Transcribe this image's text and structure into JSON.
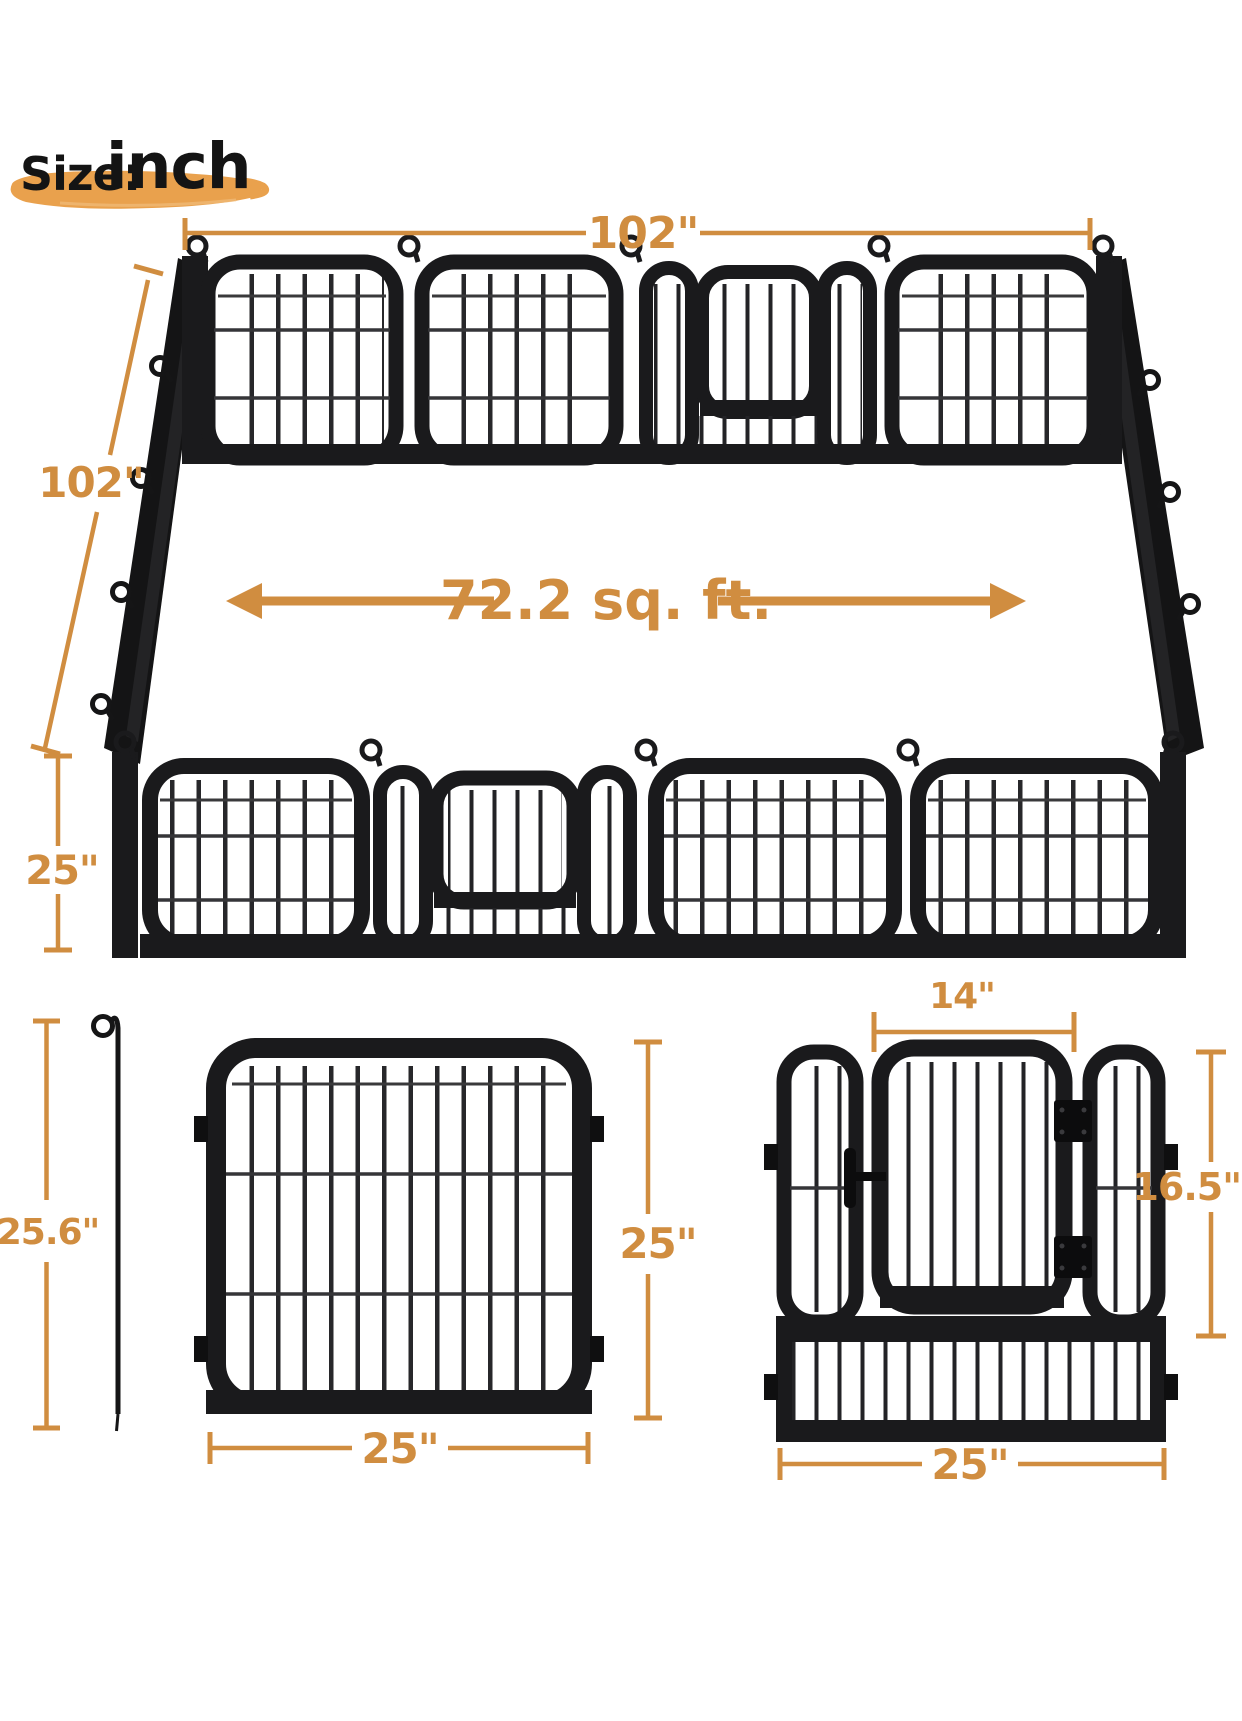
{
  "title": {
    "size_label": "Size:",
    "unit_label": "inch"
  },
  "pen": {
    "top_width": "102\"",
    "side_depth": "102\"",
    "front_height": "25\"",
    "area": "72.2 sq. ft."
  },
  "panel_fig": {
    "stake_height": "25.6\"",
    "height": "25\"",
    "width": "25\""
  },
  "gate_fig": {
    "door_width": "14\"",
    "door_height": "16.5\"",
    "width": "25\""
  },
  "colors": {
    "accent": "#D08D40",
    "brush": "#E9A14D",
    "frame": "#1A1A1C"
  }
}
